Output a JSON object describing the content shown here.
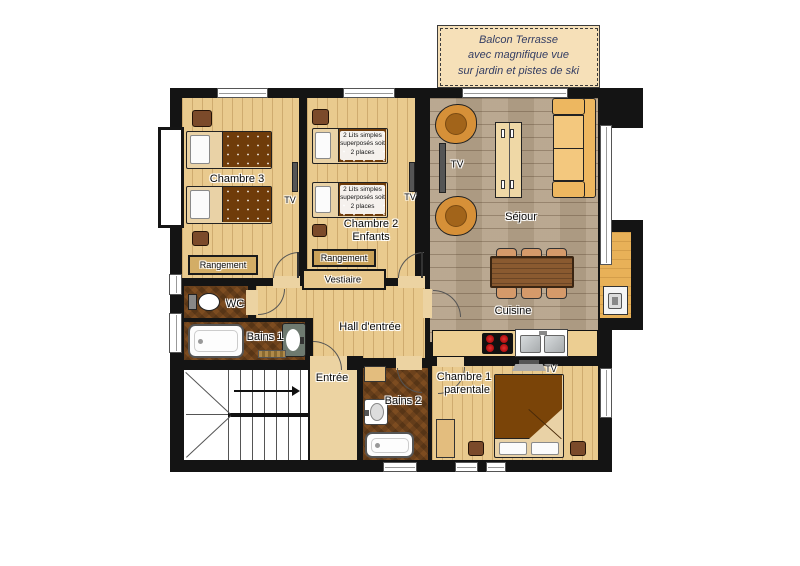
{
  "note": {
    "line1": "Balcon Terrasse",
    "line2": "avec magnifique vue",
    "line3": "sur jardin et pistes de ski"
  },
  "rooms": {
    "chambre3": "Chambre 3",
    "chambre2_line1": "Chambre 2",
    "chambre2_line2": "Enfants",
    "sejour": "Séjour",
    "cuisine": "Cuisine",
    "chambre1_line1": "Chambre 1",
    "chambre1_line2": "parentale",
    "hall": "Hall d'entrée",
    "entree": "Entrée",
    "wc": "WC",
    "bains1": "Bains 1",
    "bains2": "Bains 2",
    "vestiaire": "Vestiaire",
    "rangement": "Rangement"
  },
  "furniture": {
    "tv": "TV",
    "bunk_label": "2 Lits simples superposés soit 2 places"
  },
  "palette": {
    "wall": "#141414",
    "floor_bedrooms": "#e9ca8e",
    "floor_living": "#b5a289",
    "floor_bathrooms": "#7d4c20",
    "note_background": "#f6e0b8",
    "bed_cover": "#6f3c0a",
    "armchair": "#d69038",
    "sofa": "#edb760"
  }
}
